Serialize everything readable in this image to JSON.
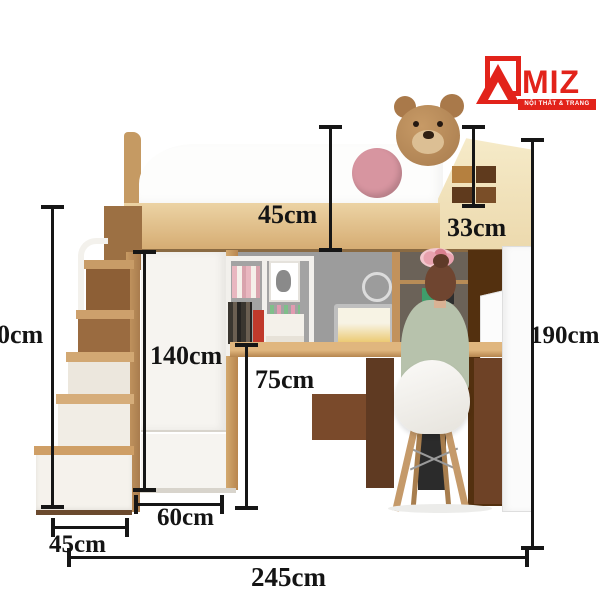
{
  "logo": {
    "brand_initial": "A",
    "brand_rest": "MIZ",
    "tagline": "NỘI THẤT & TRANG TRÍ",
    "color": "#e2231a"
  },
  "dims": {
    "upper_bunk_height": "45cm",
    "headboard_shelf_height": "33cm",
    "left_partial_height": "0cm",
    "wardrobe_height": "140cm",
    "desk_height": "75cm",
    "overall_height": "190cm",
    "desk_depth": "60cm",
    "stair_width": "45cm",
    "overall_width": "245cm"
  },
  "scene": {
    "objects": [
      "loft bed",
      "teddy bear",
      "pink circle decor",
      "house-shaped headboard shelf",
      "staircase with drawers",
      "wardrobe",
      "wall shelf with books",
      "laptop",
      "desk",
      "person seated",
      "white chair with wooden legs",
      "open white door"
    ]
  },
  "colors": {
    "wood_light": "#d9ae77",
    "wood_dark": "#6e4226",
    "accent_pink": "#d795a0",
    "wall_gray": "#9c9c9c",
    "logo_red": "#e2231a",
    "dimension_line": "#161616"
  }
}
